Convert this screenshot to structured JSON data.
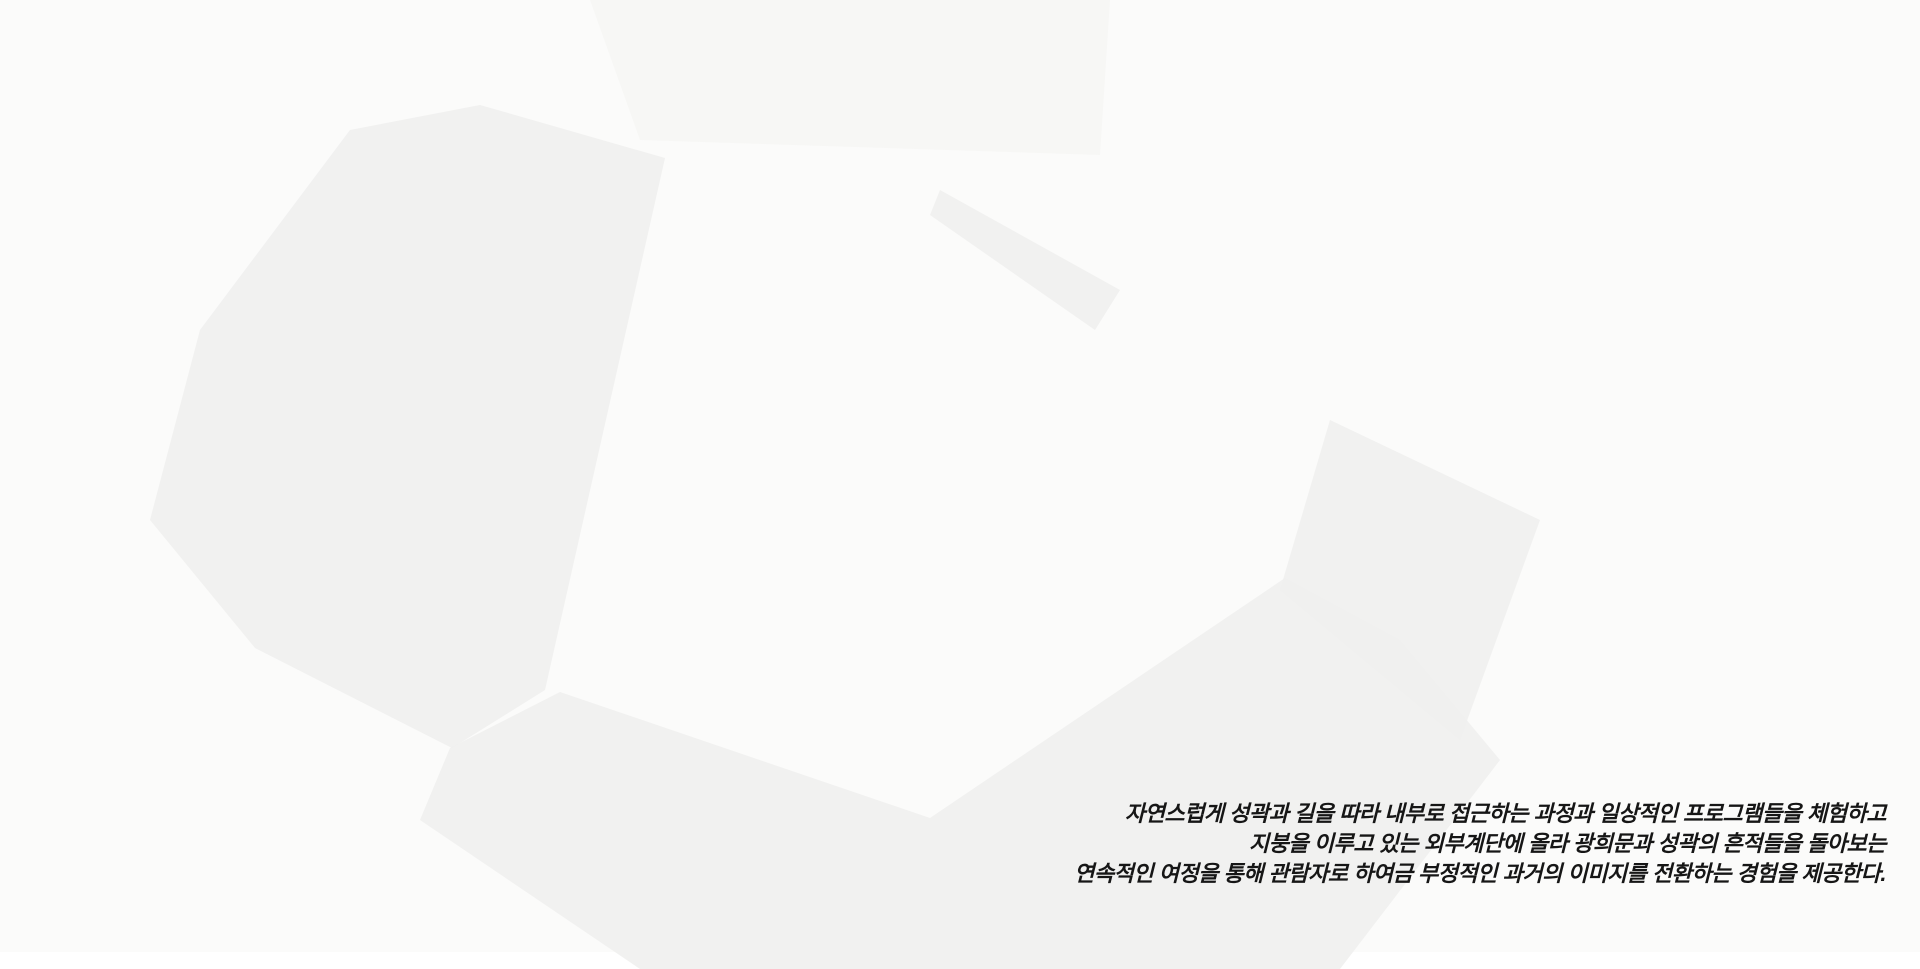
{
  "caption": {
    "lines": [
      "자연스럽게 성곽과 길을 따라 내부로 접근하는 과정과 일상적인 프로그램들을 체험하고",
      "지붕을 이루고 있는 외부계단에 올라 광희문과 성곽의 흔적들을 돌아보는",
      "연속적인 여정을 통해 관람자로 하여금 부정적인 과거의 이미지를 전환하는 경험을 제공한다."
    ],
    "text_color": "#161616"
  },
  "palette": {
    "background": "#fbfbfa",
    "road": "#f0f0ee",
    "context_fill": "#ffffff",
    "context_face_left": "#fafaf9",
    "context_face_right": "#f3f3f2",
    "context_line": "#d6d6d4",
    "context_shadow": "#e8e8e6",
    "park_green": "#e5e8db",
    "stair_green": "#dfe3d0",
    "stair_line": "#b7bea6",
    "roof_green": "#d9dfc9",
    "lawn_green": "#dde3cf",
    "plaza_gray": "#e3e4e0",
    "walk_gray": "#e8e8e4",
    "wall_stone": "#b2aca2",
    "wall_cap": "#d6d2ca",
    "gate_roof": "#6e6e6c",
    "gate_base": "#84837f",
    "tower_glass": "#d5d8d9",
    "tower_glass_side": "#c9cdcf",
    "tower_mullion": "#7c7f81",
    "tower_floor": "#63666a",
    "tower_base": "#a3a3a1",
    "tower_base_side": "#8f8f8d",
    "tower_roof": "#e9eae8",
    "wing_wall": "#d3d1ca",
    "glass_strip": "#b6baba",
    "fascia": "#98968f",
    "tree_leaf": "#9ba595",
    "tree_leaf_light": "#aeb7a6",
    "tree_trunk": "#6b665e",
    "figure": "#4c4c4c",
    "annotation": "#1a1a1a",
    "crosswalk_light": "#cdcdcb",
    "crosswalk_dark": "#8c8c8a"
  }
}
